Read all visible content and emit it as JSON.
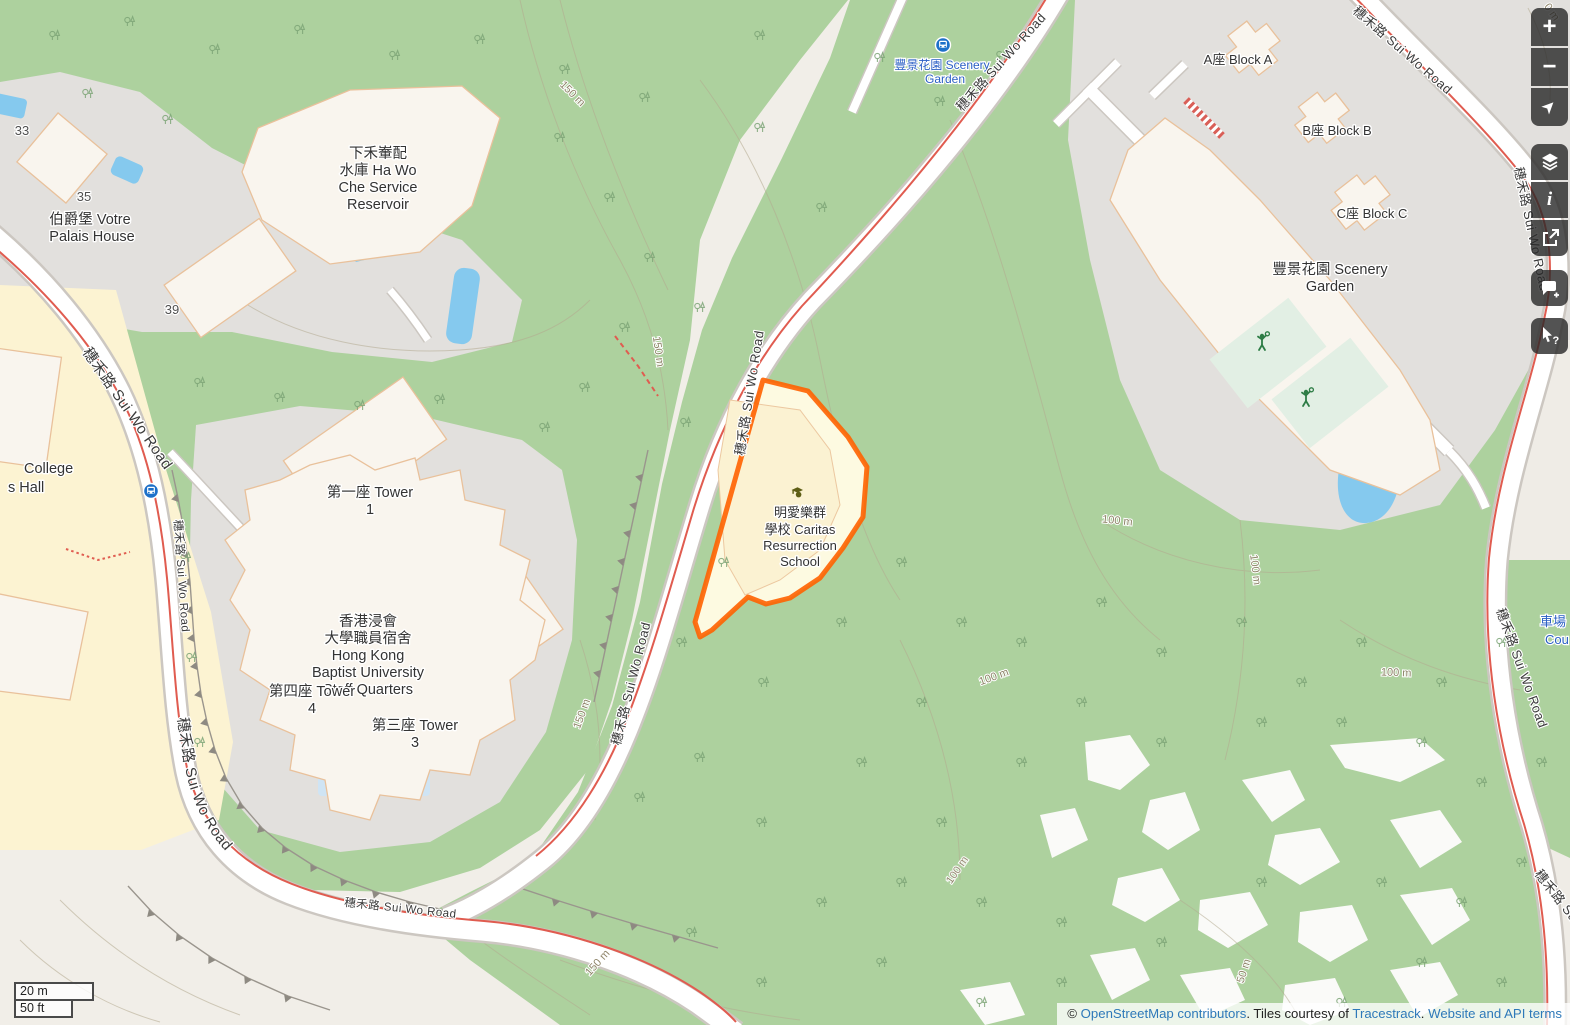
{
  "map_labels": {
    "road_sui_wo": "穗禾路 Sui Wo Road",
    "reservoir": [
      "下禾輋配",
      "水庫 Ha Wo",
      "Che Service",
      "Reservoir"
    ],
    "votre_palais": [
      "伯爵堡 Votre",
      "Palais House"
    ],
    "house_33": "33",
    "house_35": "35",
    "house_39": "39",
    "college_hall": [
      "College",
      "s Hall"
    ],
    "tower1": [
      "第一座 Tower",
      "1"
    ],
    "tower4": [
      "第四座 Tower",
      "4"
    ],
    "tower3": [
      "第三座 Tower",
      "3"
    ],
    "hkbu": [
      "香港浸會",
      "大學職員宿舍",
      "Hong Kong",
      "Baptist University",
      "Staff Quarters"
    ],
    "school": [
      "明愛樂群",
      "學校 Caritas",
      "Resurrection",
      "School"
    ],
    "block_a": "A座 Block A",
    "block_b": "B座 Block B",
    "block_c": "C座 Block C",
    "scenery_garden": [
      "豐景花園 Scenery",
      "Garden"
    ],
    "scenery_garden_stop": [
      "豐景花園 Scenery",
      "Garden"
    ],
    "court_partial": [
      "車場",
      "Cou"
    ],
    "contour_150": "150 m",
    "contour_100": "100 m",
    "contour_50": "50 m",
    "contour_0": "0 m"
  },
  "controls": {
    "zoom_in": "+",
    "zoom_out": "−",
    "locate": "➤",
    "info": "i",
    "query_mark": "?"
  },
  "scale_bar": {
    "metric": "20 m",
    "imperial": "50 ft"
  },
  "attribution": {
    "copyright": "© ",
    "osm_link": "OpenStreetMap contributors",
    "tiles_text": ". Tiles courtesy of ",
    "tracestrack_link": "Tracestrack",
    "separator": ". ",
    "terms_link": "Website and API terms"
  },
  "colors": {
    "selection_orange": "#ff6200",
    "forest_green": "#add19e",
    "water_blue": "#85c9ee",
    "residential_gray": "#e2e0dd",
    "campus_yellow": "#fcf3d2",
    "school_yellow": "#fdfae1",
    "link_blue": "#2e79b9",
    "footpath_red": "#e05c50",
    "transit_blue": "#1d70c9"
  }
}
